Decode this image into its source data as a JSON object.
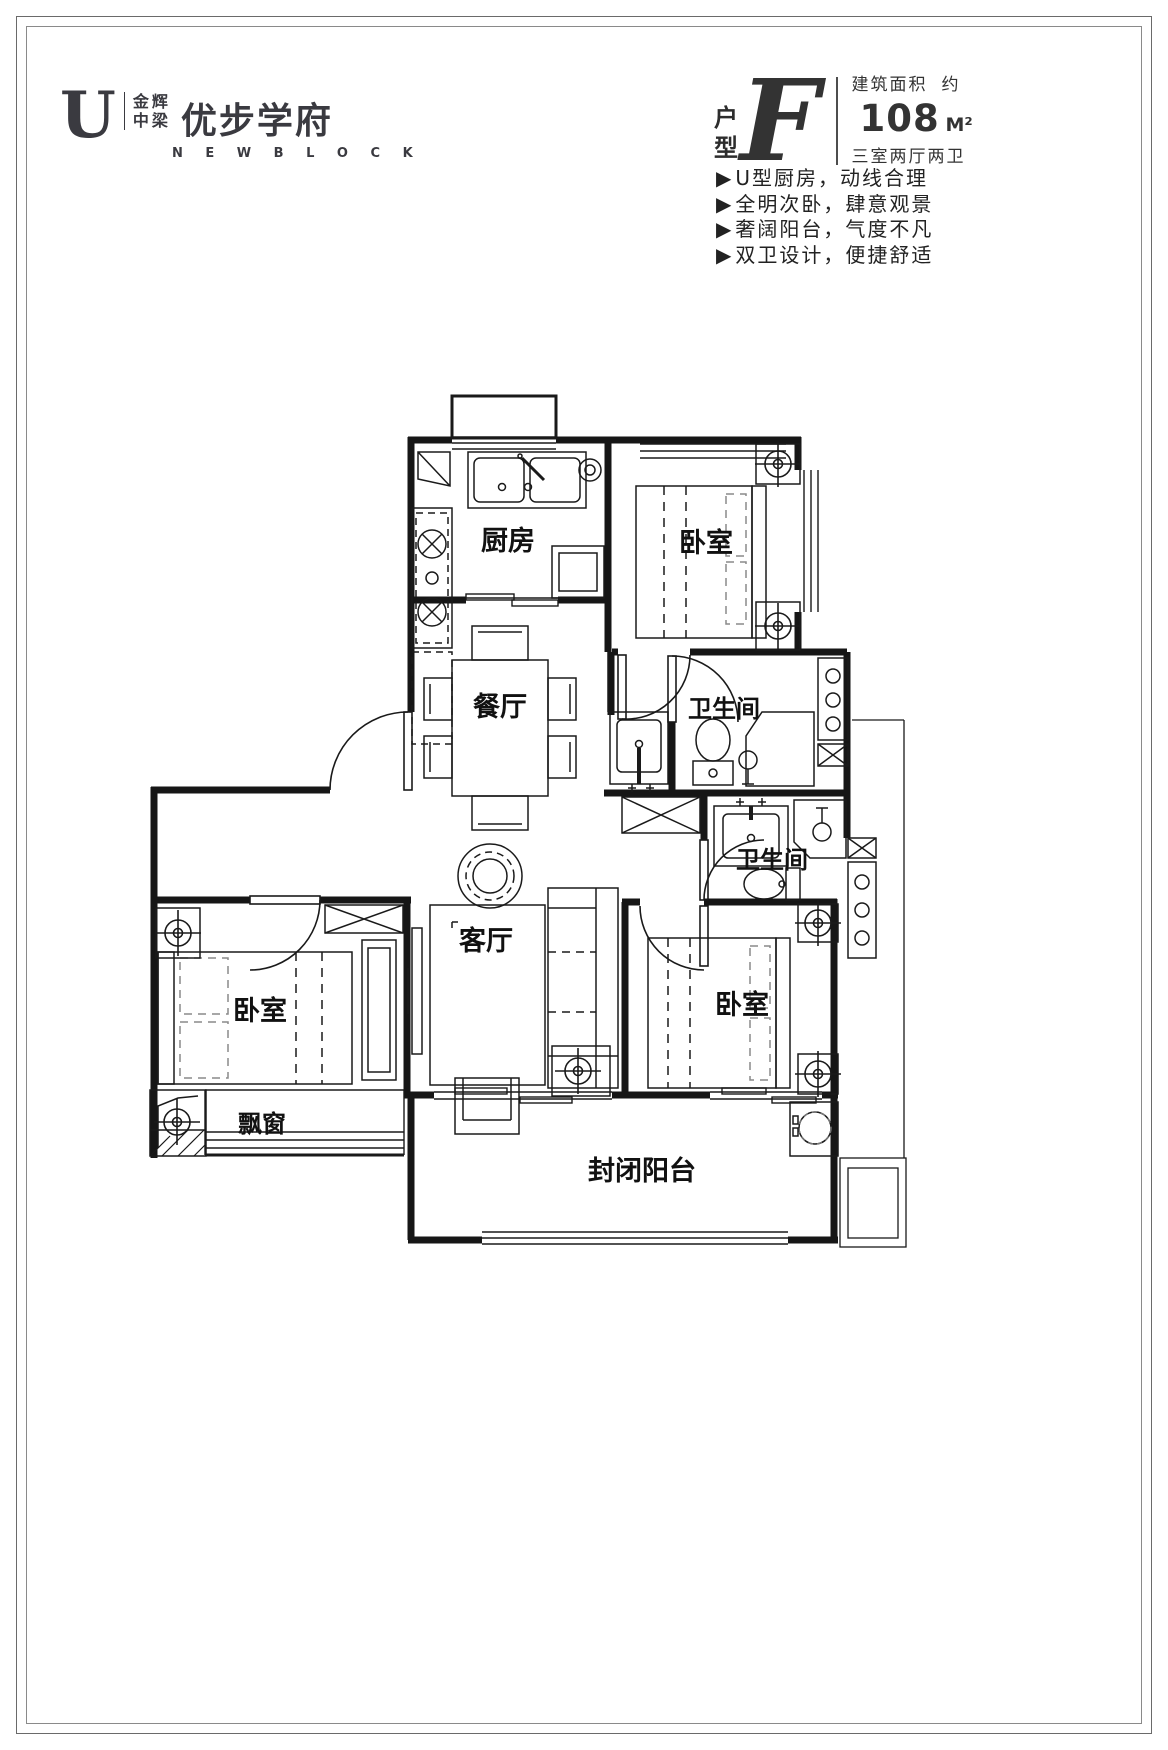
{
  "logo": {
    "u_glyph": "U",
    "brand_top": "金辉",
    "brand_bottom": "中梁",
    "name": "优步学府",
    "subtitle": "N E W   B L O C K"
  },
  "unit": {
    "type_char_1": "户",
    "type_char_2": "型",
    "type_letter": "F",
    "area_label": "建筑面积",
    "area_approx": "约",
    "area_value": "108",
    "area_unit": "M²",
    "rooms_summary": "三室两厅两卫"
  },
  "feature_bullet": "▶",
  "features": [
    "U型厨房，动线合理",
    "全明次卧，肆意观景",
    "奢阔阳台，气度不凡",
    "双卫设计，便捷舒适"
  ],
  "floorplan": {
    "rooms": {
      "kitchen": "厨房",
      "bedroom_top": "卧室",
      "bedroom_left": "卧室",
      "bedroom_bottom": "卧室",
      "bath_upper": "卫生间",
      "bath_lower": "卫生间",
      "dining": "餐厅",
      "living": "客厅",
      "bay_window": "飘窗",
      "balcony": "封闭阳台"
    },
    "ink": "#1a1a1a"
  }
}
